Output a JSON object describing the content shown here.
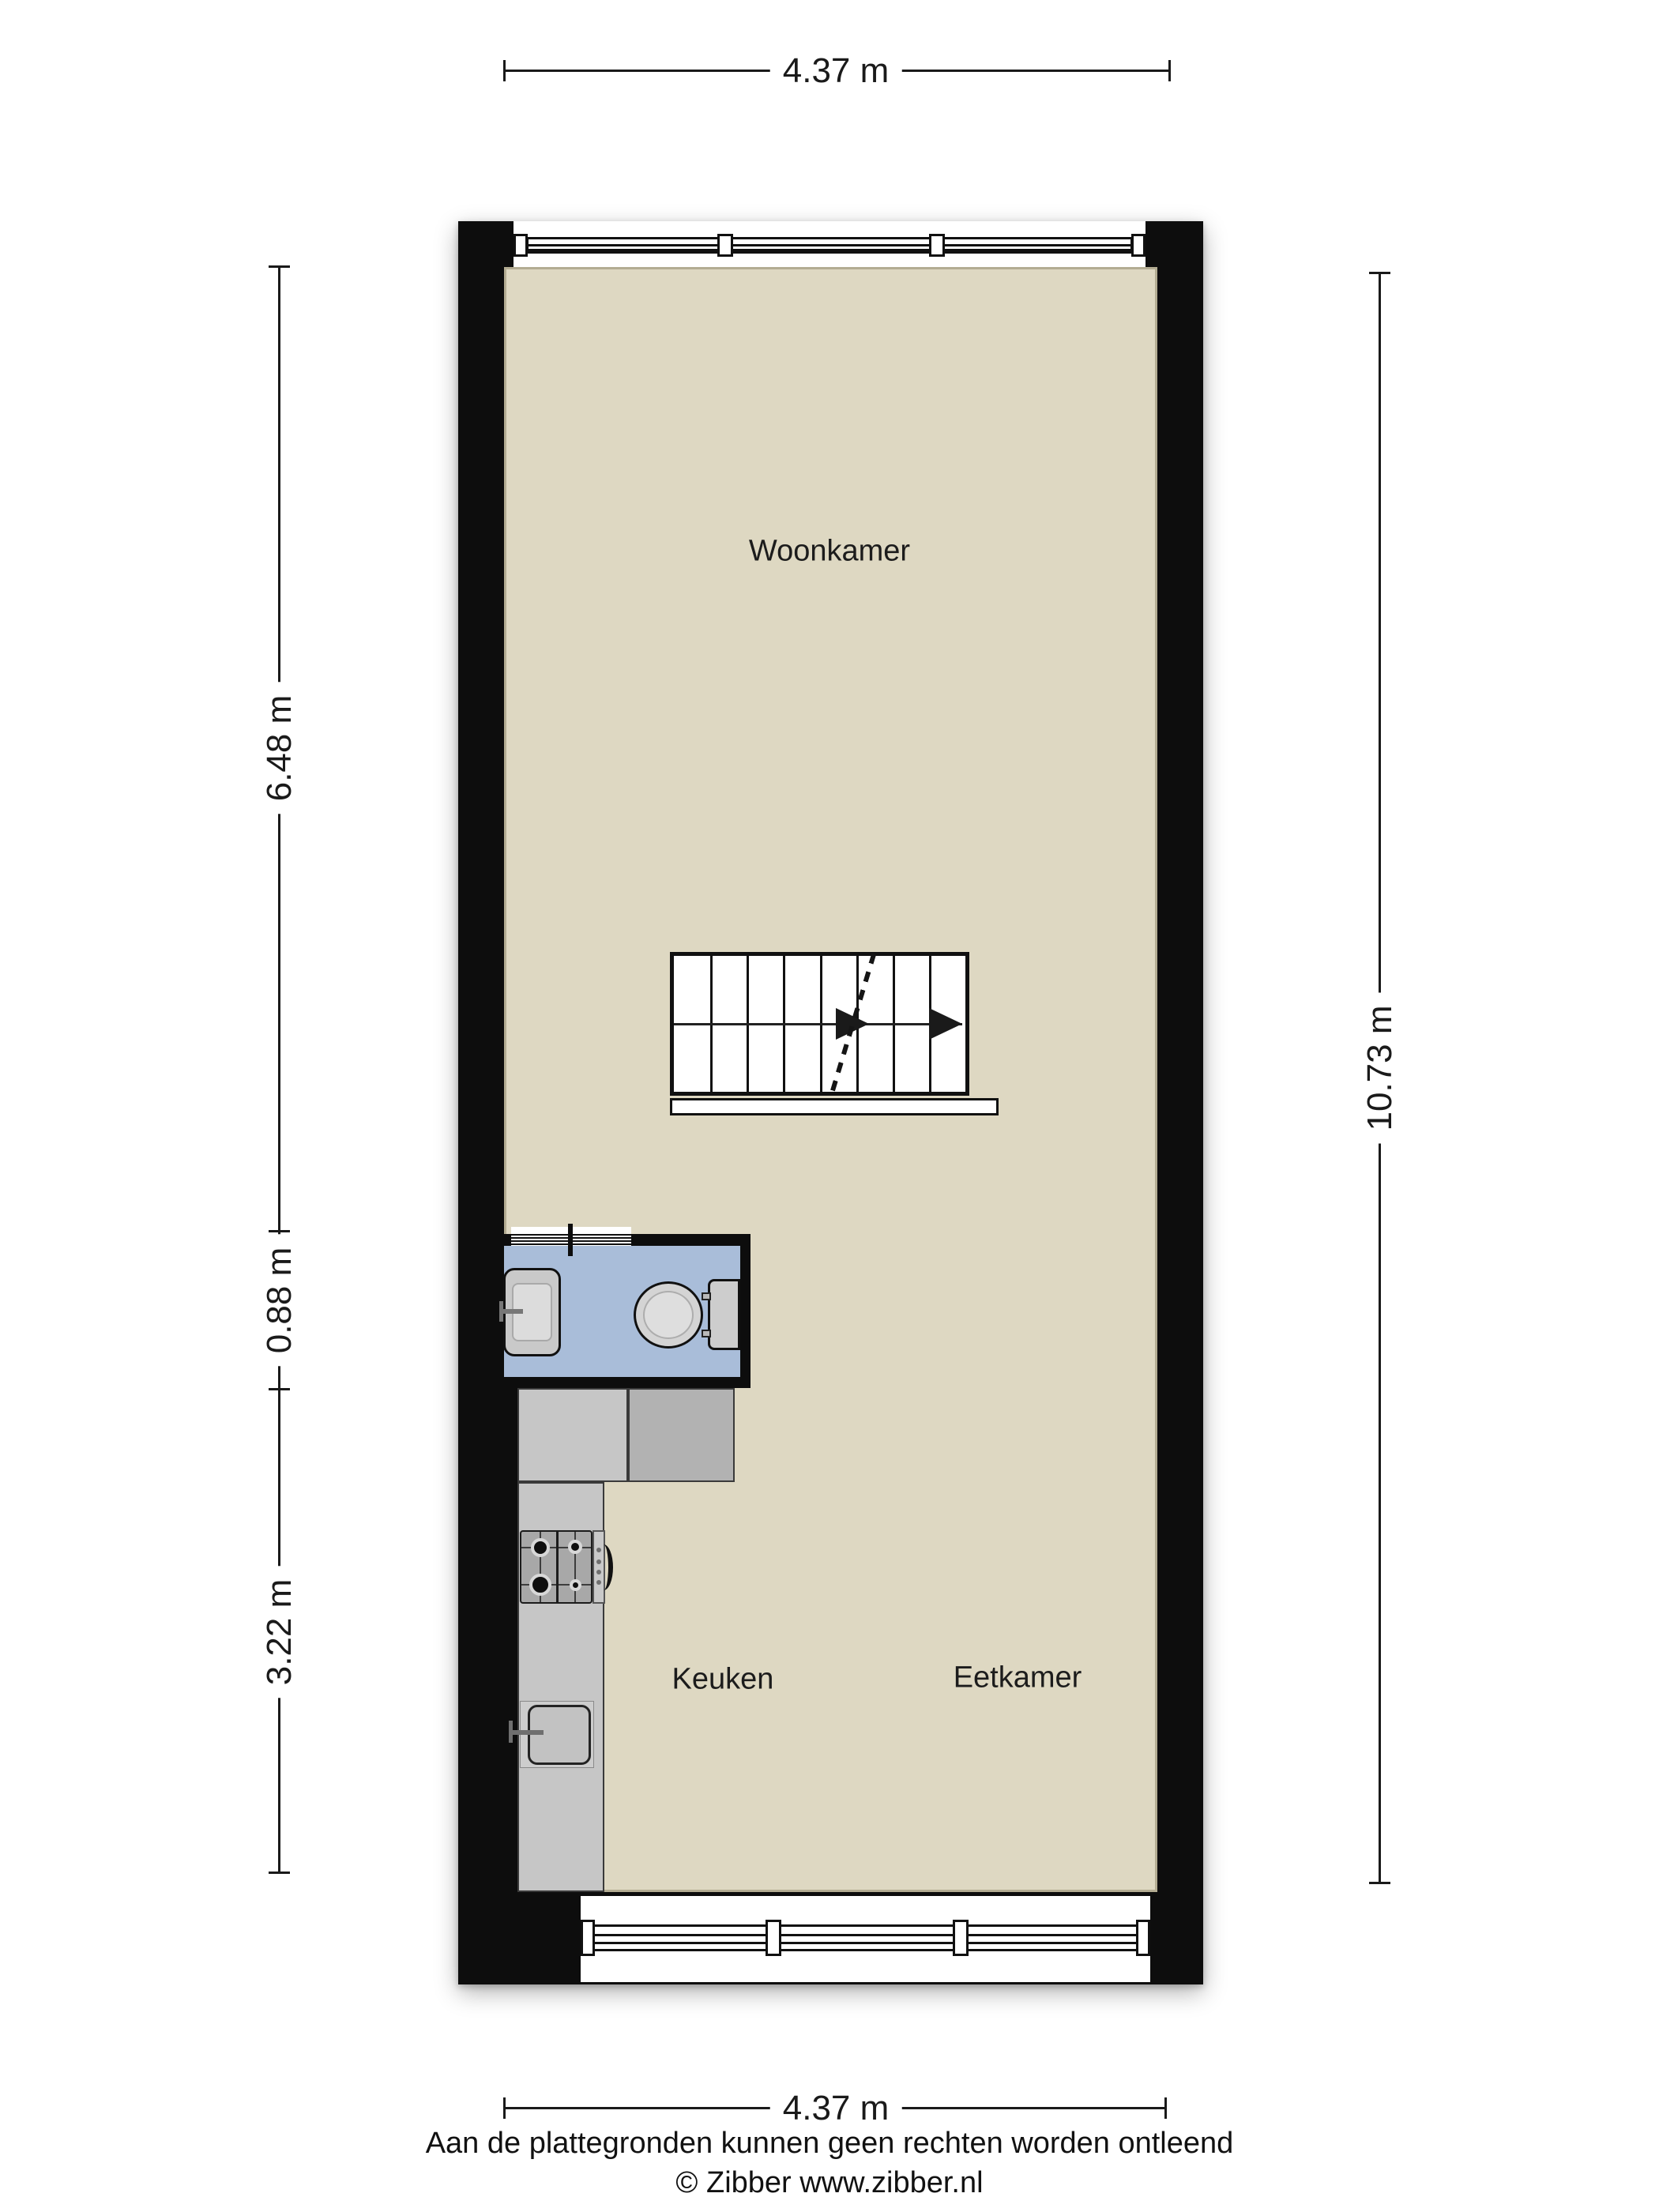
{
  "rooms": [
    {
      "label": "Woonkamer"
    },
    {
      "label": "Keuken"
    },
    {
      "label": "Eetkamer"
    }
  ],
  "dimensions": {
    "top": "4.37 m",
    "bottom": "4.37 m",
    "right": "10.73 m",
    "left_top": "6.48 m",
    "left_middle": "0.88 m",
    "left_bottom": "3.22 m"
  },
  "footer": {
    "disclaimer": "Aan de plattegronden kunnen geen rechten worden ontleend",
    "credit": "© Zibber www.zibber.nl"
  },
  "colors": {
    "wall": "#0d0d0d",
    "floor": "#ded8c2",
    "floor_border": "#b3ac92",
    "toilet_floor": "#a9bdd9",
    "counter": "#c6c6c6",
    "counter_dark": "#b2b2b2",
    "fixture_fill": "#d4d4d4",
    "stove": "#a8a8a8",
    "ink": "#1a1a1a"
  }
}
